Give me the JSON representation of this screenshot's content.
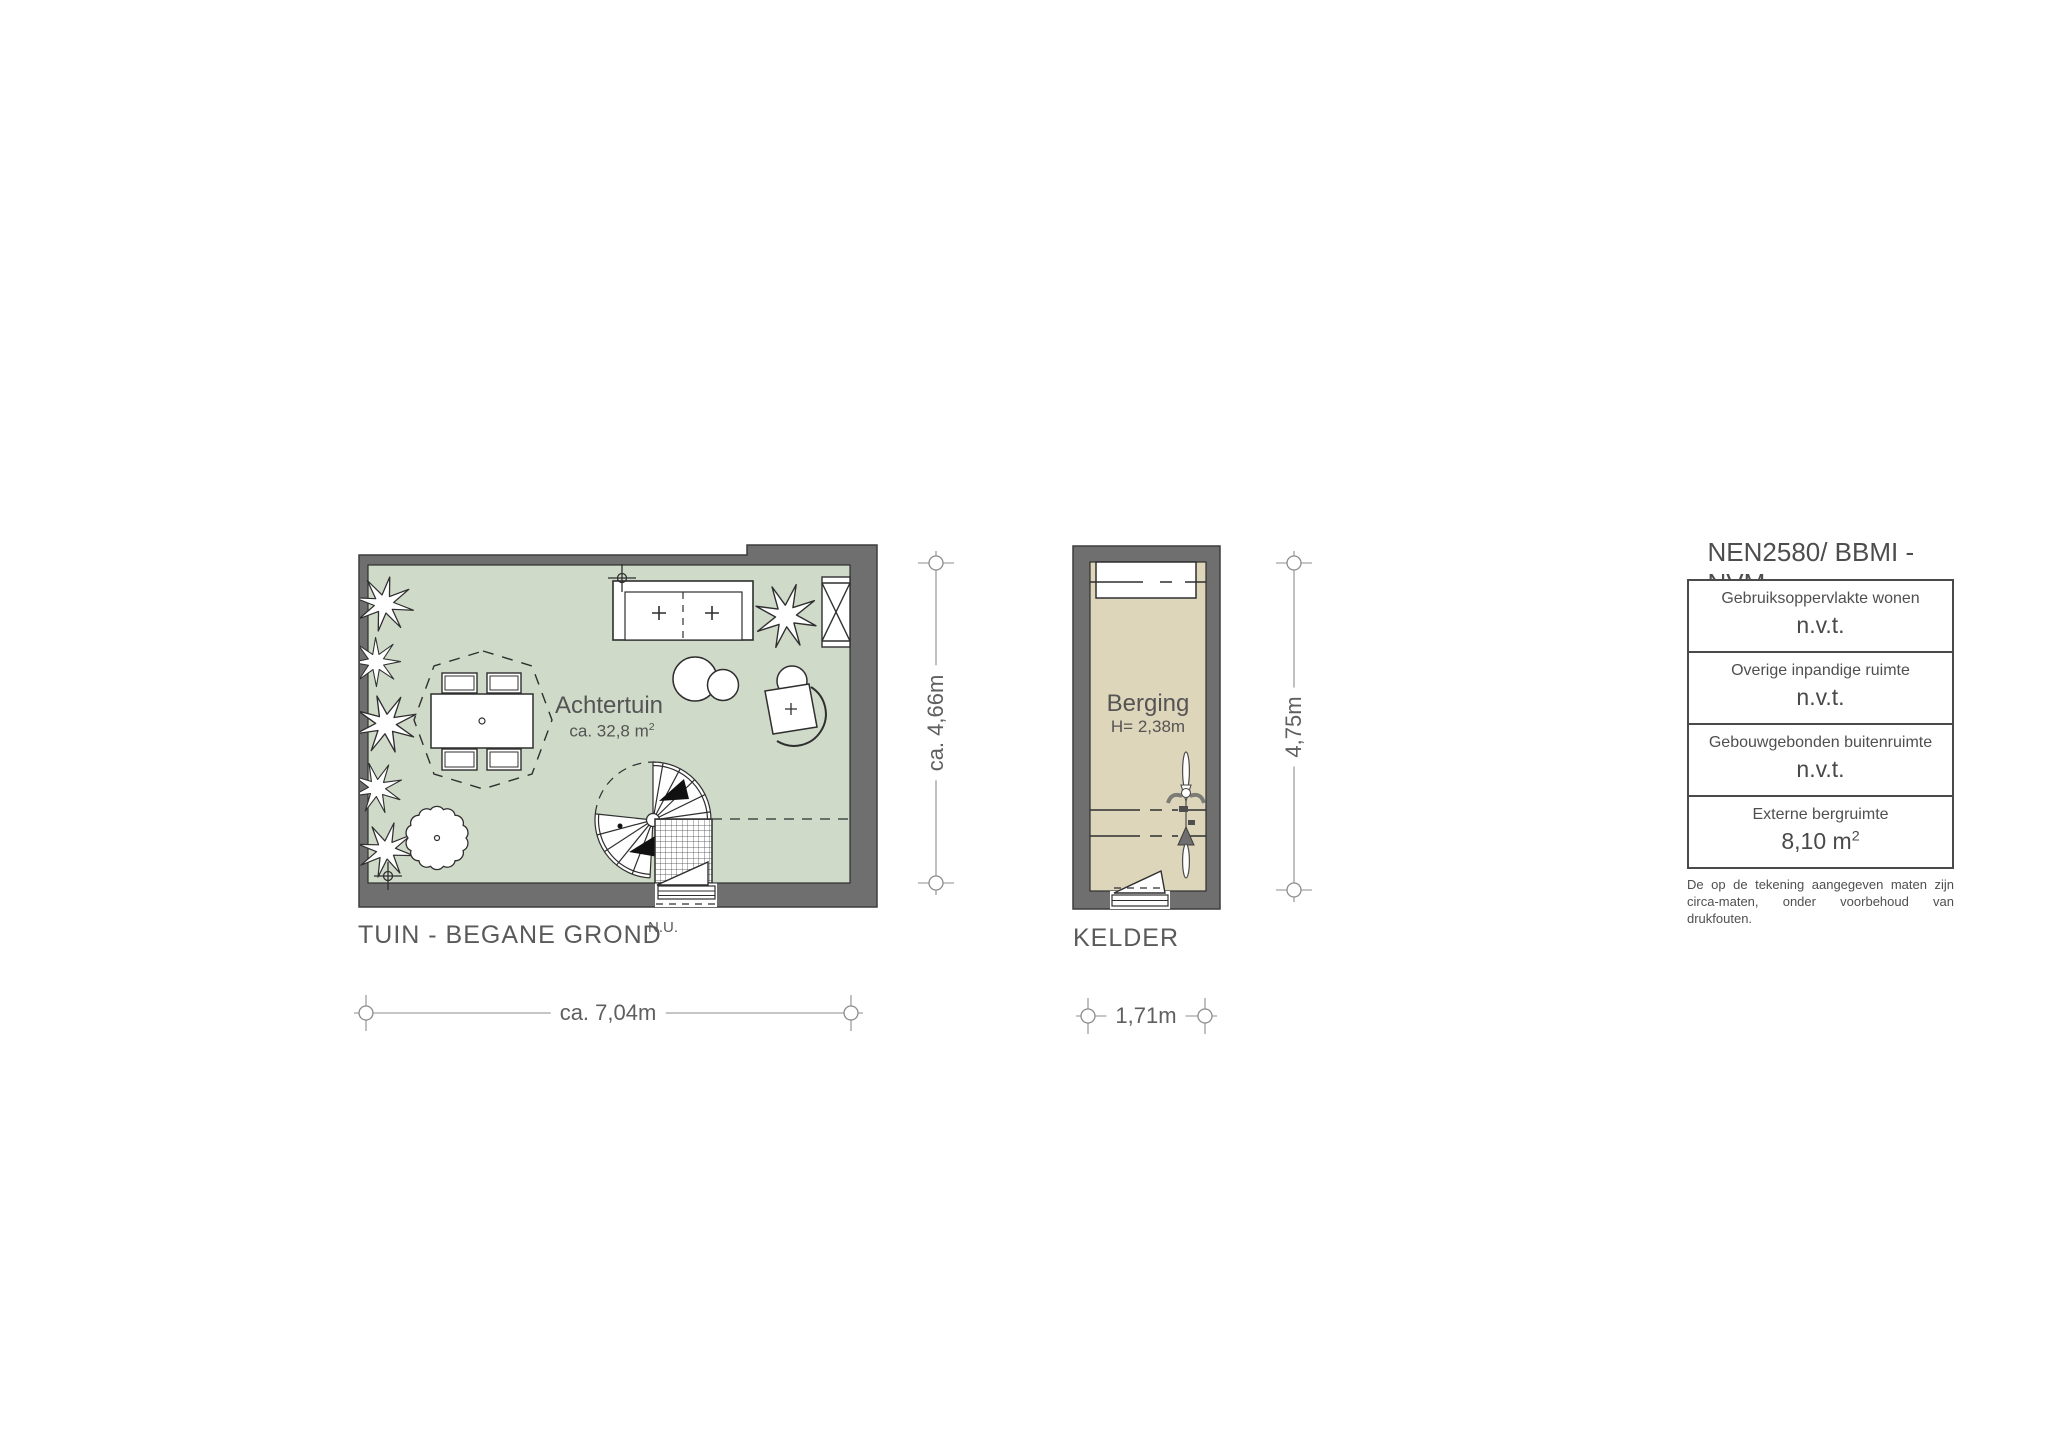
{
  "garden": {
    "title": "TUIN - BEGANE GROND",
    "room": "Achtertuin",
    "area_prefix": "ca. 32,8 m",
    "area_sup": "2",
    "door_note": "N.U.",
    "dim_width": "ca. 7,04m",
    "dim_height": "ca. 4,66m"
  },
  "kelder": {
    "title": "KELDER",
    "room": "Berging",
    "height_note": "H= 2,38m",
    "dim_width": "1,71m",
    "dim_height": "4,75m"
  },
  "legend": {
    "title": "NEN2580/ BBMI - NVM",
    "rows": [
      {
        "label": "Gebruiksoppervlakte wonen",
        "value": "n.v.t.",
        "sup": ""
      },
      {
        "label": "Overige inpandige ruimte",
        "value": "n.v.t.",
        "sup": ""
      },
      {
        "label": "Gebouwgebonden buitenruimte",
        "value": "n.v.t.",
        "sup": ""
      },
      {
        "label": "Externe bergruimte",
        "value": "8,10 m",
        "sup": "2"
      }
    ],
    "disclaimer_line1": "De op de tekening aangegeven maten zijn",
    "disclaimer_line2": "circa-maten, onder voorbehoud van drukfouten."
  },
  "colors": {
    "wall": "#6f6f6f",
    "garden_floor": "#cfdac9",
    "kelder_floor": "#ded6ba",
    "linework": "#2f2f2f",
    "dimension": "#8c8c8c",
    "text": "#525252"
  }
}
